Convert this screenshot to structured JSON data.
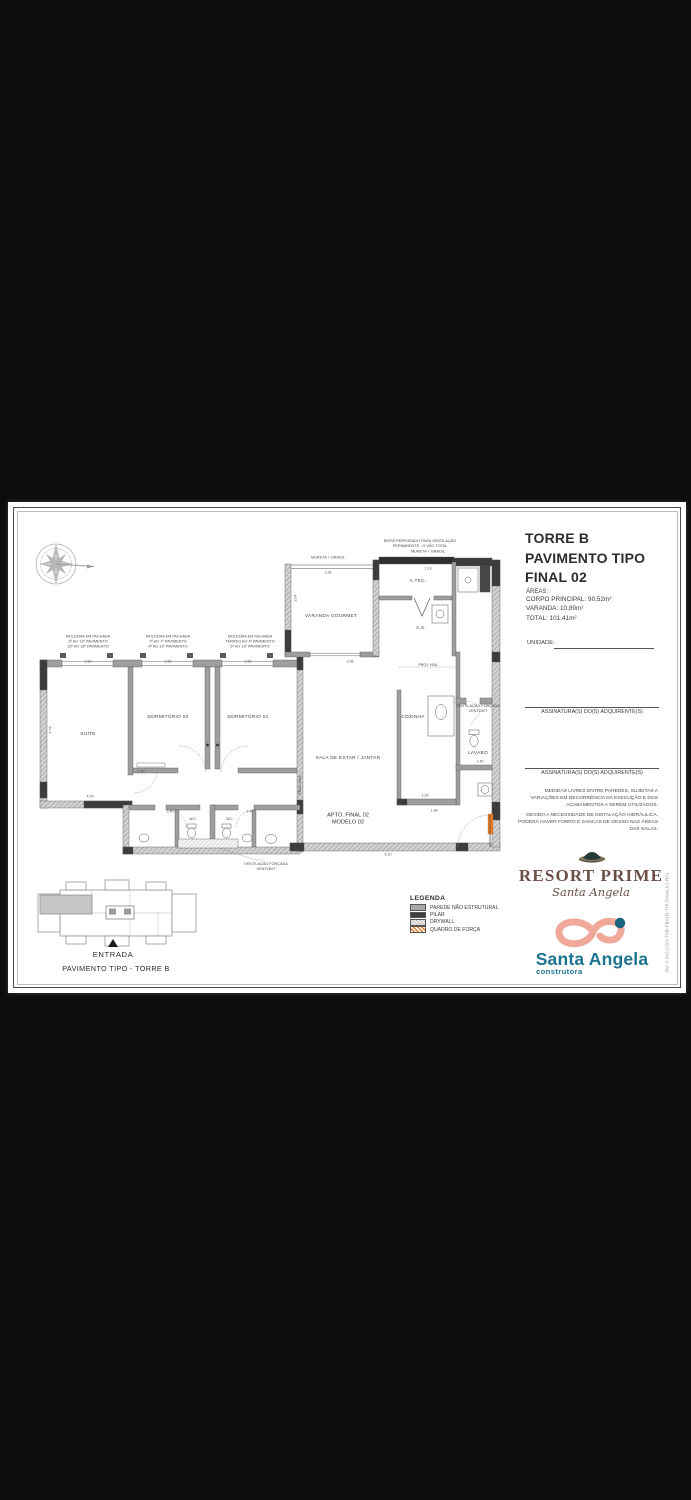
{
  "title": {
    "lines": "TORRE B\nPAVIMENTO TIPO\nFINAL 02"
  },
  "areas": {
    "heading": "ÁREAS:",
    "corpo": "CORPO PRINCIPAL: 90,52m²",
    "varanda": "VARANDA: 10,89m²",
    "total": "TOTAL: 101,41m²"
  },
  "unidade": {
    "label": "UNIDADE:"
  },
  "signatures": {
    "s1": "ASSINATURA(S) DO(S) ADQUIRENTE(S)",
    "s2": "ASSINATURA(S) DO(S) ADQUIRENTE(S)"
  },
  "notes": {
    "n1": "MEDIDAS LIVRES ENTRE PAREDES, SUJEITAS A VARIAÇÕES EM DECORRÊNCIA DA EXECUÇÃO E DOS ACABAMENTOS A SEREM UTILIZADOS.",
    "n2": "DEVIDO A NECESSIDADE DE INSTALAÇÃO HIDRÁULICA, PODERÁ HAVER FORRO E SANCAS DE GESSO NAS ÁREAS DAS SALAS."
  },
  "plan": {
    "rooms": {
      "suite": "SUÍTE",
      "dorm2": "DORMITÓRIO 02",
      "dorm1": "DORMITÓRIO 01",
      "sala": "SALA DE ESTAR / JANTAR",
      "varanda": "VARANDA GOURMET",
      "atec": "A.TEC.",
      "as": "A.S.",
      "cozinha": "COZINHA",
      "lavabo": "LAVABO",
      "wc1": "W.C.",
      "wc2": "W.C."
    },
    "apto": "APTO. FINAL 02\nMODELO 02",
    "ann": {
      "brise": "BRISE PERFURADO PARA VENTILAÇÃO\nPERMANENTE - H VÃO TOTAL",
      "mureta1": "MURETA + GRADIL",
      "mureta2": "MURETA + GRADIL",
      "mold1": "MOLDURA EM FACHADA\n3º AO 13º PAVIMENTO\n15º AO 18º PAVIMENTO",
      "mold2": "MOLDURA EM FACHADA\n2º AO 7º PAVIMENTO\n9º AO 13º PAVIMENTO",
      "mold3": "MOLDURA EM FACHADA\nTÉRREO AO 4º PAVIMENTO\n6º AO 13º PAVIMENTO",
      "vent1": "VENTILAÇÃO FORÇADA\nVENTOKIT",
      "vent2": "VENTILAÇÃO FORÇADA\nVENTOKIT",
      "proj1": "PROJ. VIGA",
      "proj2": "PROJ. VIGA"
    },
    "dims": [
      "2.80",
      "2.50",
      "2.50",
      "4.75",
      "4.00",
      "1.40",
      "2.40",
      "2.40",
      "3.34",
      "2.04",
      "1.19",
      "3.98",
      "5.10",
      "1.30",
      "1.98",
      "1.40"
    ]
  },
  "legend": {
    "title": "LEGENDA",
    "items": [
      {
        "swatch": "parede-nao-estrutural",
        "label": "PAREDE NÃO ESTRUTURAL"
      },
      {
        "swatch": "pilar",
        "label": "PILAR"
      },
      {
        "swatch": "drywall",
        "label": "DRYWALL"
      },
      {
        "swatch": "quadro-de-forca",
        "label": "QUADRO DE FORÇA"
      }
    ]
  },
  "key_plan": {
    "entrada": "ENTRADA",
    "caption": "PAVIMENTO TIPO  - TORRE B"
  },
  "brand": {
    "resort_name": "RESORT PRIME",
    "resort_script": "Santa Angela",
    "construtora_name": "Santa Angela",
    "construtora_sub": "construtora"
  },
  "side_code": "BU-3 INC-COV-T0B-FB01B-TIP-FINAL02-R01",
  "colors": {
    "accent_orange": "#ed7d23",
    "brand_teal": "#1c7391",
    "brand_brown": "#6b4f46",
    "swan_pink": "#f0a89a",
    "letterbox": "#0d0d0d"
  }
}
